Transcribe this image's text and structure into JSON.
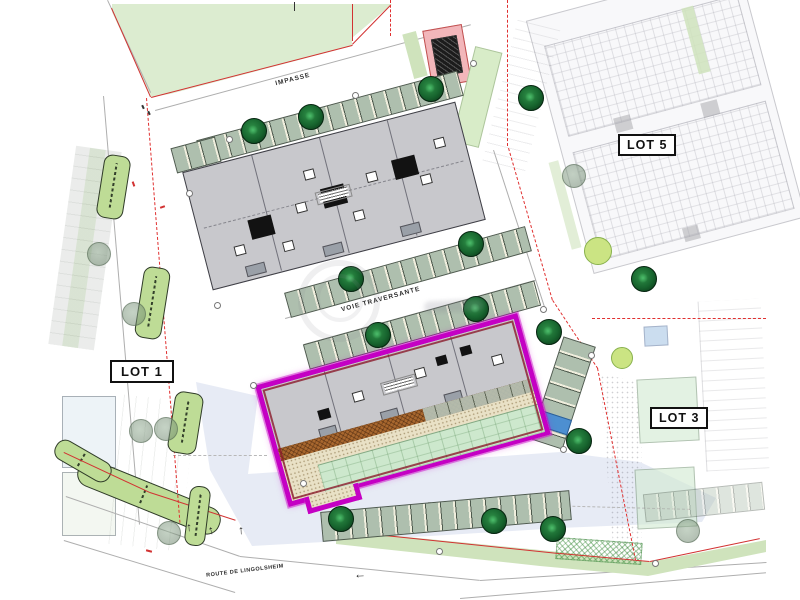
{
  "labels": {
    "lot1": "LOT 1",
    "lot3": "LOT 3",
    "lot5": "LOT 5",
    "impasse": "IMPASSE",
    "voie_traversante": "VOIE TRAVERSANTE",
    "route_de_lingolsheim": "ROUTE DE LINGOLSHEIM"
  },
  "icons": {
    "arrow_up": "↑",
    "arrow_left": "←"
  },
  "colors": {
    "highlight_outline_magenta": "#c400c4",
    "inner_boundary_maroon": "#8a1a2a",
    "field_green": "#dcecd0",
    "median_green": "#bedc96",
    "roof_gray": "#c8c8cc",
    "mint_green": "#cde8cd",
    "walkway_brown": "#a8672e",
    "boundary_red": "#d23232",
    "tree_dark_green": "#17642e",
    "lavender_wash": "#dfe4f2",
    "disabled_stall_blue": "#4d8fd1",
    "bin_shelter_pink": "#f2b6ba"
  }
}
